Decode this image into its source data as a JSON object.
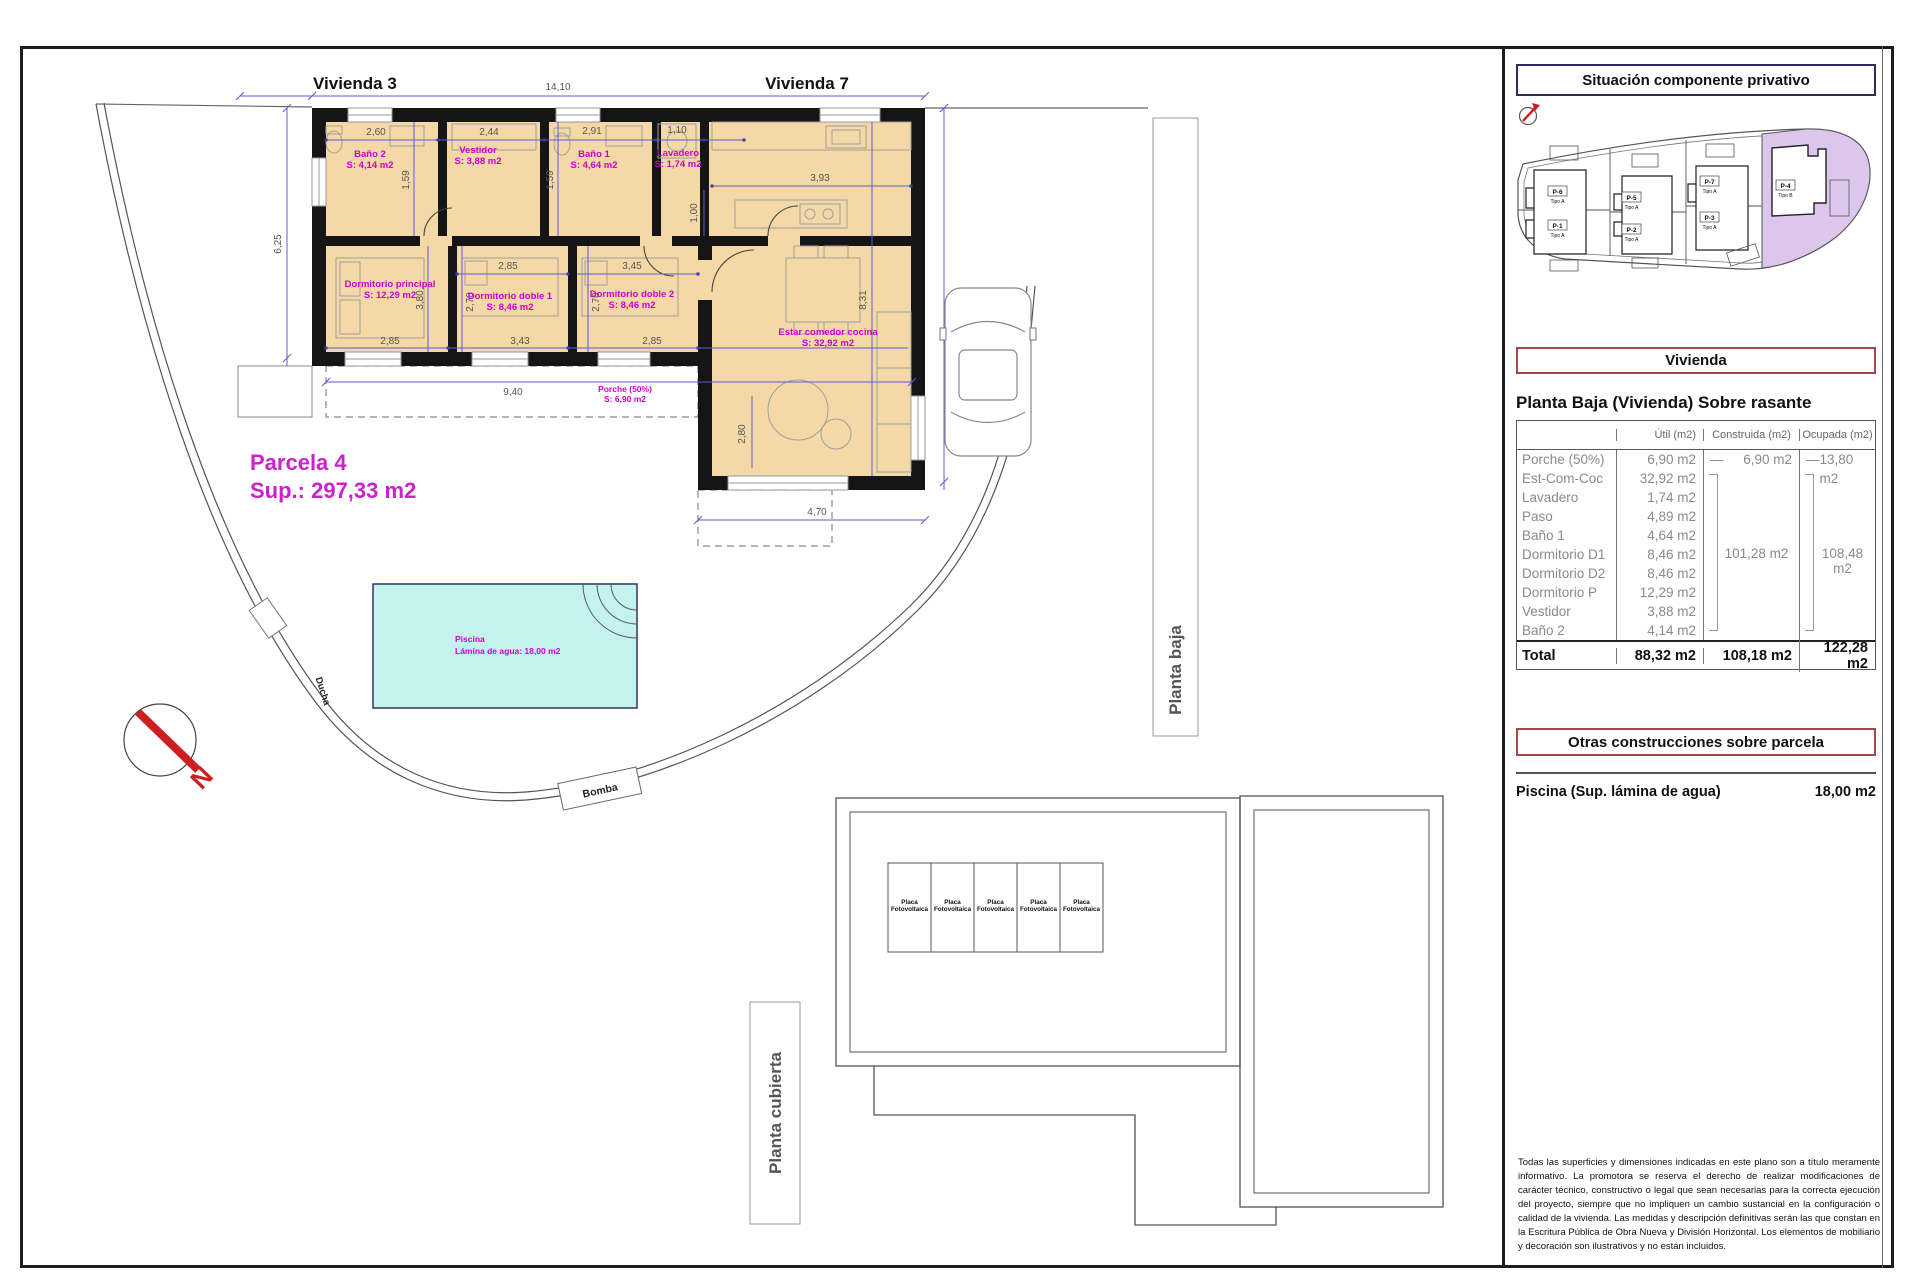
{
  "colors": {
    "floor": "#f4d8a6",
    "pool": "#c4f2ec",
    "magenta": "#cc00cc",
    "wall": "#151515",
    "dimline": "#5c5cd6",
    "parcel_highlight": "#ddc6ec",
    "red_box": "#a34848",
    "navy_box": "#2b2b5e",
    "north_red": "#cc2020"
  },
  "plan": {
    "vivienda3": "Vivienda 3",
    "vivienda7": "Vivienda 7",
    "parcela_line1": "Parcela 4",
    "parcela_line2": "Sup.: 297,33 m2",
    "rooms": [
      {
        "name": "Baño 2",
        "area": "S: 4,14 m2"
      },
      {
        "name": "Vestidor",
        "area": "S: 3,88 m2"
      },
      {
        "name": "Baño 1",
        "area": "S: 4,64 m2"
      },
      {
        "name": "Lavadero",
        "area": "S: 1,74 m2"
      },
      {
        "name": "Dormitorio principal",
        "area": "S: 12,29 m2"
      },
      {
        "name": "Dormitorio doble 1",
        "area": "S: 8,46 m2"
      },
      {
        "name": "Dormitorio doble 2",
        "area": "S: 8,46 m2"
      },
      {
        "name": "Estar comedor cocina",
        "area": "S: 32,92 m2"
      },
      {
        "name": "Porche (50%)",
        "area": "S: 6,90 m2"
      }
    ],
    "pool": {
      "name": "Piscina",
      "detail": "Lámina de agua: 18,00 m2"
    },
    "ducha": "Ducha",
    "bomba": "Bomba",
    "north": "N",
    "planta_baja": "Planta baja",
    "dims": {
      "total_w": "14,10",
      "parcel_left": "6,25",
      "bath2_w": "2,60",
      "vestidor_w": "2,44",
      "bath1_w": "2,91",
      "lavadero_w": "1,10",
      "bath2_h": "1,59",
      "bath1_h": "1,59",
      "dorm1_w": "2,85",
      "dorm2_w": "3,45",
      "dormP_h": "3,80",
      "dorm1_h": "2,70",
      "dorm2_h": "2,70",
      "dormP_w": "2,85",
      "dorm1_w2": "3,43",
      "dorm2_w2": "2,85",
      "paso_h": "1,00",
      "kitchen_w": "3,93",
      "salon_h": "8,31",
      "porch_w": "9,40",
      "right_h": "9,13",
      "terrace_w": "4,70",
      "terrace_h": "2,80"
    }
  },
  "roof": {
    "planta_cubierta": "Planta cubierta",
    "panel_line1": "Placa",
    "panel_line2": "Fotovoltaica"
  },
  "sidebar": {
    "situacion_title": "Situación componente privativo",
    "plots": [
      {
        "id": "P-6",
        "tipo": "Tipo A"
      },
      {
        "id": "P-1",
        "tipo": "Tipo A"
      },
      {
        "id": "P-5",
        "tipo": "Tipo A"
      },
      {
        "id": "P-2",
        "tipo": "Tipo A"
      },
      {
        "id": "P-7",
        "tipo": "Tipo A"
      },
      {
        "id": "P-3",
        "tipo": "Tipo A"
      },
      {
        "id": "P-4",
        "tipo": "Tipo B"
      }
    ],
    "vivienda_title": "Vivienda",
    "planta_heading": "Planta Baja (Vivienda) Sobre rasante",
    "table": {
      "headers": {
        "util": "Útil (m2)",
        "construida": "Construida (m2)",
        "ocupada": "Ocupada (m2)"
      },
      "rows": [
        {
          "name": "Porche (50%)",
          "util": "6,90 m2"
        },
        {
          "name": "Est-Com-Coc",
          "util": "32,92 m2"
        },
        {
          "name": "Lavadero",
          "util": "1,74 m2"
        },
        {
          "name": "Paso",
          "util": "4,89 m2"
        },
        {
          "name": "Baño 1",
          "util": "4,64 m2"
        },
        {
          "name": "Dormitorio D1",
          "util": "8,46 m2"
        },
        {
          "name": "Dormitorio D2",
          "util": "8,46 m2"
        },
        {
          "name": "Dormitorio P",
          "util": "12,29 m2"
        },
        {
          "name": "Vestidor",
          "util": "3,88 m2"
        },
        {
          "name": "Baño 2",
          "util": "4,14 m2"
        }
      ],
      "construida": {
        "dash": "—",
        "first": "6,90 m2",
        "group": "101,28 m2"
      },
      "ocupada": {
        "dash": "—",
        "first": "13,80 m2",
        "group": "108,48 m2"
      },
      "total": {
        "label": "Total",
        "util": "88,32 m2",
        "construida": "108,18 m2",
        "ocupada": "122,28 m2"
      }
    },
    "otras_title": "Otras construcciones sobre parcela",
    "piscina_label": "Piscina (Sup. lámina de agua)",
    "piscina_value": "18,00 m2",
    "disclaimer": "Todas las superficies y dimensiones indicadas en este plano son a título meramente informativo. La promotora se reserva el derecho de realizar modificaciones de carácter técnico, constructivo o legal que sean necesarias para la correcta ejecución del proyecto, siempre que no impliquen un cambio sustancial en la configuración o calidad de la vivienda. Las medidas y descripción definitivas serán las que constan en la Escritura Pública de Obra Nueva y División Horizontal. Los elementos de mobiliario y decoración son ilustrativos y no están incluidos."
  }
}
